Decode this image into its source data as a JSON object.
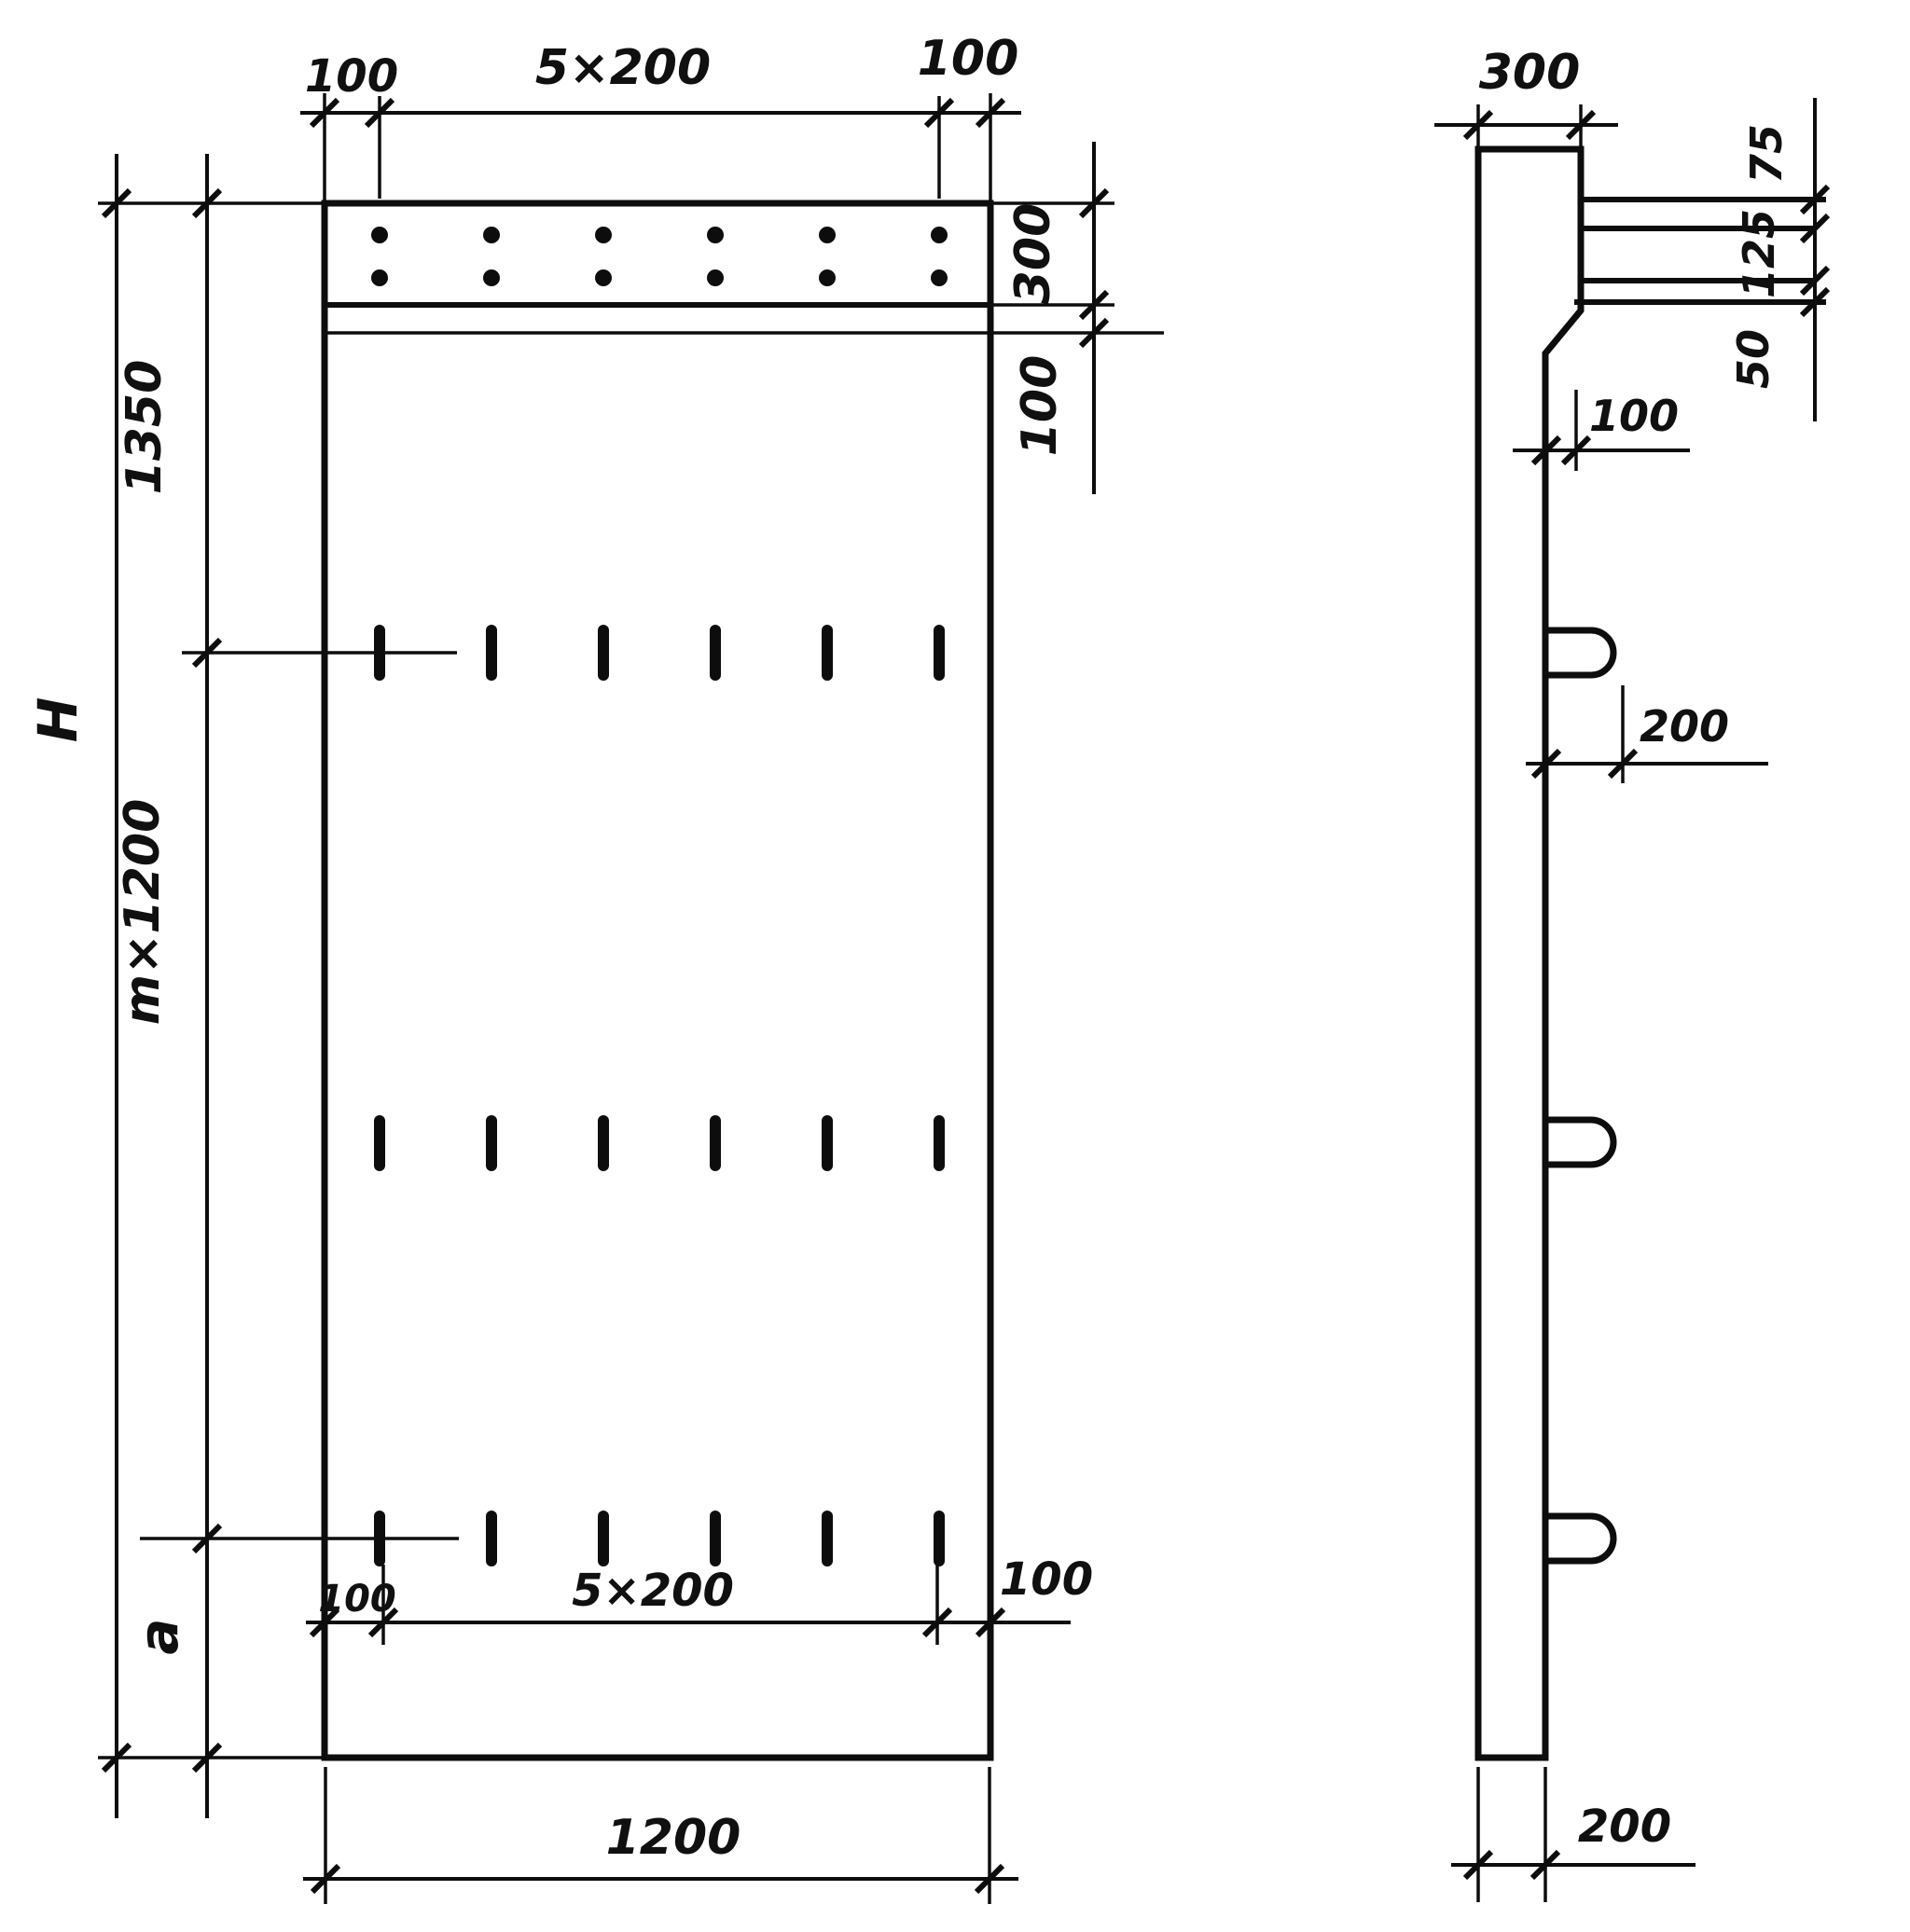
{
  "front_view": {
    "top_dim": {
      "left_margin": "100",
      "spacing": "5×200",
      "right_margin": "100"
    },
    "right_dim": {
      "band_height": "300",
      "offset": "100"
    },
    "left_dim": {
      "overall_height": "H",
      "top_segment": "1350",
      "middle_segment": "m×1200",
      "bottom_segment": "a"
    },
    "bottom_dim": {
      "left_margin": "100",
      "spacing": "5×200",
      "right_margin": "100",
      "overall_width": "1200"
    }
  },
  "side_view": {
    "top_dim": {
      "thickness": "300"
    },
    "right_dim": {
      "top": "75",
      "middle": "125",
      "bottom": "50"
    },
    "step_dim": {
      "offset": "100"
    },
    "loop_dim": {
      "projection": "200"
    },
    "bottom_dim": {
      "thickness": "200"
    }
  }
}
